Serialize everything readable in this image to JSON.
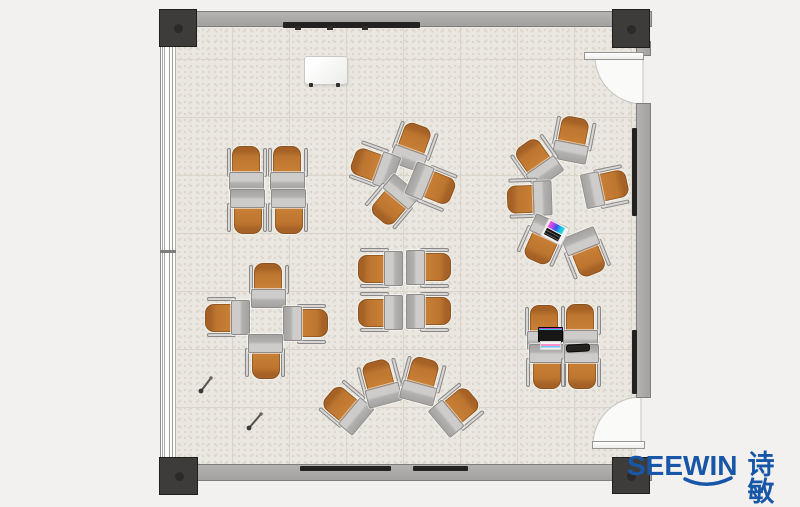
{
  "canvas": {
    "width": 800,
    "height": 507
  },
  "colors": {
    "background": "#f2f1ef",
    "floor": "#eae7e0",
    "tile_line": "#d9d5c9",
    "wall": "#a9a8a6",
    "column": "#3d3c3a",
    "chair_orange": "#c47a31",
    "desk_gray": "#b3b1af",
    "board_dark": "#232220",
    "brand_blue": "#1857a8"
  },
  "logo": {
    "brand": "SEEWIN",
    "cn": "诗敏",
    "color": "#1857a8"
  },
  "plan": {
    "floor": {
      "x": 176,
      "y": 27,
      "w": 460,
      "h": 438
    },
    "walls": [
      {
        "name": "wall-top",
        "x": 159,
        "y": 11,
        "w": 493,
        "h": 16,
        "vert": false
      },
      {
        "name": "wall-bottom",
        "x": 159,
        "y": 464,
        "w": 493,
        "h": 17,
        "vert": false
      },
      {
        "name": "wall-right-stub",
        "x": 636,
        "y": 41,
        "w": 15,
        "h": 15,
        "vert": true
      },
      {
        "name": "wall-right-main",
        "x": 636,
        "y": 103,
        "w": 15,
        "h": 295,
        "vert": true
      }
    ],
    "columns": [
      {
        "name": "column-top-left",
        "x": 159,
        "y": 9,
        "w": 38,
        "h": 38
      },
      {
        "name": "column-top-right",
        "x": 612,
        "y": 9,
        "w": 38,
        "h": 39
      },
      {
        "name": "column-bottom-left",
        "x": 159,
        "y": 457,
        "w": 39,
        "h": 38
      },
      {
        "name": "column-bottom-right",
        "x": 612,
        "y": 457,
        "w": 38,
        "h": 37
      }
    ],
    "window": {
      "x": 160,
      "y": 46,
      "w": 16,
      "h": 412,
      "mullion_y": 204
    },
    "doors": [
      {
        "name": "door-top-right",
        "leaf": {
          "x": 584,
          "y": 52,
          "w": 60,
          "h": 8
        },
        "swing_path": "M643,56 L595,56 A48,48 0 0 0 643,104 Z"
      },
      {
        "name": "door-bottom-right",
        "leaf": {
          "x": 592,
          "y": 441,
          "w": 53,
          "h": 8
        },
        "swing_path": "M641,445 L593,445 A48,48 0 0 1 641,397 Z"
      }
    ],
    "wall_boards": [
      {
        "name": "whiteboard-top-wall",
        "x": 283,
        "y": 22,
        "w": 137,
        "h": 6
      },
      {
        "name": "whiteboard-bottom-wall-1",
        "x": 300,
        "y": 466,
        "w": 91,
        "h": 5
      },
      {
        "name": "whiteboard-bottom-wall-2",
        "x": 413,
        "y": 466,
        "w": 55,
        "h": 5
      },
      {
        "name": "board-right-wall-1",
        "x": 632,
        "y": 128,
        "w": 5,
        "h": 88
      },
      {
        "name": "board-right-wall-2",
        "x": 632,
        "y": 330,
        "w": 5,
        "h": 64
      }
    ],
    "board_ticks": [
      {
        "x": 295,
        "y": 26,
        "w": 6,
        "h": 4
      },
      {
        "x": 327,
        "y": 26,
        "w": 6,
        "h": 4
      },
      {
        "x": 362,
        "y": 26,
        "w": 6,
        "h": 4
      }
    ],
    "units": [
      {
        "x": 247,
        "y": 169,
        "r": 0
      },
      {
        "x": 288,
        "y": 169,
        "r": 0
      },
      {
        "x": 247,
        "y": 211,
        "r": 180
      },
      {
        "x": 288,
        "y": 211,
        "r": 180
      },
      {
        "x": 413,
        "y": 147,
        "r": 20
      },
      {
        "x": 375,
        "y": 166,
        "r": -70
      },
      {
        "x": 393,
        "y": 201,
        "r": -140
      },
      {
        "x": 431,
        "y": 186,
        "r": 112
      },
      {
        "x": 573,
        "y": 140,
        "r": 11
      },
      {
        "x": 538,
        "y": 162,
        "r": -35
      },
      {
        "x": 530,
        "y": 198,
        "r": -92
      },
      {
        "x": 605,
        "y": 188,
        "r": 78
      },
      {
        "x": 543,
        "y": 240,
        "r": -156
      },
      {
        "x": 585,
        "y": 253,
        "r": 158
      },
      {
        "x": 381,
        "y": 268,
        "r": -90
      },
      {
        "x": 428,
        "y": 268,
        "r": 90
      },
      {
        "x": 381,
        "y": 312,
        "r": -90
      },
      {
        "x": 428,
        "y": 312,
        "r": 90
      },
      {
        "x": 269,
        "y": 286,
        "r": 0
      },
      {
        "x": 228,
        "y": 317,
        "r": -90
      },
      {
        "x": 305,
        "y": 324,
        "r": 90
      },
      {
        "x": 265,
        "y": 356,
        "r": 180
      },
      {
        "x": 347,
        "y": 408,
        "r": -50
      },
      {
        "x": 381,
        "y": 383,
        "r": -15
      },
      {
        "x": 422,
        "y": 381,
        "r": 15
      },
      {
        "x": 456,
        "y": 411,
        "r": 50
      },
      {
        "x": 545,
        "y": 328,
        "r": 0
      },
      {
        "x": 581,
        "y": 327,
        "r": 0
      },
      {
        "x": 546,
        "y": 366,
        "r": 180
      },
      {
        "x": 581,
        "y": 366,
        "r": 180
      }
    ],
    "props": {
      "flipchart": {
        "x": 304,
        "y": 56,
        "w": 42,
        "h": 27,
        "feet": [
          {
            "x": 309,
            "y": 83
          },
          {
            "x": 336,
            "y": 83
          }
        ]
      },
      "laptop_rotated": {
        "x": 555,
        "y": 232,
        "r": 28
      },
      "laptop_open": {
        "panel": {
          "x": 538,
          "y": 327,
          "w": 23,
          "h": 13
        },
        "strip": {
          "x": 540,
          "y": 341,
          "w": 19,
          "h": 7
        }
      },
      "tablet": {
        "x": 566,
        "y": 344,
        "w": 22,
        "h": 6,
        "r": -3
      },
      "pins": [
        {
          "x1": 201,
          "y1": 391,
          "x2": 211,
          "y2": 378
        },
        {
          "x1": 249,
          "y1": 428,
          "x2": 261,
          "y2": 414
        }
      ]
    }
  }
}
